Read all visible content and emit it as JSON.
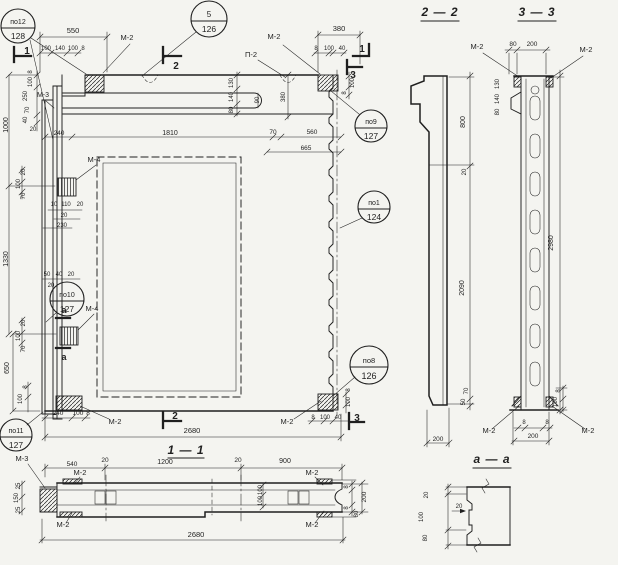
{
  "drawing": {
    "bg_color": "#f4f4f0",
    "ink_color": "#1f1f1f",
    "section_titles": {
      "s11": "1 — 1",
      "s22": "2 — 2",
      "s33": "3 — 3",
      "saa": "а — а"
    },
    "callouts": [
      {
        "top": "по12",
        "bot": "128"
      },
      {
        "top": "5",
        "bot": "126"
      },
      {
        "top": "по9",
        "bot": "127"
      },
      {
        "top": "по1",
        "bot": "124"
      },
      {
        "top": "по8",
        "bot": "126"
      },
      {
        "top": "по10",
        "bot": "127"
      },
      {
        "top": "по11",
        "bot": "127"
      }
    ],
    "labels": [
      {
        "t": "550",
        "x": 73,
        "y": 33
      },
      {
        "t": "100",
        "x": 46,
        "y": 50,
        "f": 6
      },
      {
        "t": "140",
        "x": 60,
        "y": 50,
        "f": 6
      },
      {
        "t": "100",
        "x": 73,
        "y": 50,
        "f": 6
      },
      {
        "t": "8",
        "x": 83,
        "y": 50,
        "f": 6
      },
      {
        "t": "М-2",
        "x": 127,
        "y": 40,
        "n": "mark"
      },
      {
        "t": "380",
        "x": 339,
        "y": 31
      },
      {
        "t": "8",
        "x": 316,
        "y": 50,
        "f": 6
      },
      {
        "t": "100",
        "x": 329,
        "y": 50,
        "f": 6
      },
      {
        "t": "40",
        "x": 342,
        "y": 50,
        "f": 6
      },
      {
        "t": "М-2",
        "x": 274,
        "y": 39,
        "n": "mark"
      },
      {
        "t": "П-2",
        "x": 251,
        "y": 57,
        "n": "mark"
      },
      {
        "t": "1",
        "x": 27,
        "y": 54,
        "f": 10,
        "n": "sec"
      },
      {
        "t": "2",
        "x": 176,
        "y": 69,
        "f": 10,
        "n": "sec"
      },
      {
        "t": "1",
        "x": 362,
        "y": 52,
        "f": 10,
        "n": "sec"
      },
      {
        "t": "3",
        "x": 353,
        "y": 78,
        "f": 10,
        "n": "sec"
      },
      {
        "t": "2",
        "x": 175,
        "y": 419,
        "f": 10,
        "n": "sec"
      },
      {
        "t": "3",
        "x": 357,
        "y": 421,
        "f": 10,
        "n": "sec"
      },
      {
        "t": "130",
        "x": 233,
        "y": 83,
        "r": 1,
        "f": 6
      },
      {
        "t": "140",
        "x": 233,
        "y": 97,
        "r": 1,
        "f": 6
      },
      {
        "t": "80",
        "x": 233,
        "y": 110,
        "r": 1,
        "f": 6
      },
      {
        "t": "90",
        "x": 259,
        "y": 100,
        "r": 1,
        "f": 6
      },
      {
        "t": "380",
        "x": 285,
        "y": 97,
        "r": 1,
        "f": 6
      },
      {
        "t": "100",
        "x": 354,
        "y": 83,
        "r": 1,
        "f": 6
      },
      {
        "t": "8",
        "x": 346,
        "y": 93,
        "r": 1,
        "f": 6
      },
      {
        "t": "8",
        "x": 32,
        "y": 72,
        "r": 1,
        "f": 6
      },
      {
        "t": "100",
        "x": 32,
        "y": 82,
        "r": 1,
        "f": 6
      },
      {
        "t": "250",
        "x": 27,
        "y": 96,
        "r": 1,
        "f": 6
      },
      {
        "t": "М-3",
        "x": 43,
        "y": 97,
        "n": "mark",
        "f": 7
      },
      {
        "t": "70",
        "x": 29,
        "y": 110,
        "r": 1,
        "f": 6
      },
      {
        "t": "40",
        "x": 27,
        "y": 120,
        "r": 1,
        "f": 6
      },
      {
        "t": "1000",
        "x": 8,
        "y": 125,
        "r": 1,
        "f": 7
      },
      {
        "t": "20",
        "x": 33,
        "y": 131,
        "f": 6
      },
      {
        "t": "240",
        "x": 59,
        "y": 135,
        "f": 6.5
      },
      {
        "t": "1810",
        "x": 170,
        "y": 135,
        "f": 7
      },
      {
        "t": "70",
        "x": 273,
        "y": 134,
        "f": 6.5
      },
      {
        "t": "560",
        "x": 312,
        "y": 134,
        "f": 6.5
      },
      {
        "t": "665",
        "x": 306,
        "y": 150,
        "f": 6.5
      },
      {
        "t": "М-4",
        "x": 94,
        "y": 162,
        "n": "mark"
      },
      {
        "t": "20",
        "x": 25,
        "y": 172,
        "r": 1,
        "f": 6
      },
      {
        "t": "100",
        "x": 20,
        "y": 184,
        "r": 1,
        "f": 6
      },
      {
        "t": "70",
        "x": 25,
        "y": 196,
        "r": 1,
        "f": 6
      },
      {
        "t": "10",
        "x": 54,
        "y": 206,
        "f": 6
      },
      {
        "t": "110",
        "x": 66,
        "y": 206,
        "f": 6
      },
      {
        "t": "20",
        "x": 80,
        "y": 206,
        "f": 6
      },
      {
        "t": "20",
        "x": 64,
        "y": 217,
        "f": 6
      },
      {
        "t": "230",
        "x": 62,
        "y": 227,
        "f": 6
      },
      {
        "t": "1330",
        "x": 8,
        "y": 259,
        "r": 1,
        "f": 7
      },
      {
        "t": "50",
        "x": 47,
        "y": 276,
        "f": 6
      },
      {
        "t": "40",
        "x": 59,
        "y": 276,
        "f": 6
      },
      {
        "t": "20",
        "x": 71,
        "y": 276,
        "f": 6
      },
      {
        "t": "20",
        "x": 51,
        "y": 287,
        "f": 6
      },
      {
        "t": "М-4",
        "x": 92,
        "y": 311,
        "n": "mark"
      },
      {
        "t": "а",
        "x": 64,
        "y": 313,
        "f": 9,
        "n": "sec"
      },
      {
        "t": "а",
        "x": 64,
        "y": 360,
        "f": 9,
        "n": "sec"
      },
      {
        "t": "20",
        "x": 25,
        "y": 323,
        "r": 1,
        "f": 6
      },
      {
        "t": "100",
        "x": 20,
        "y": 336,
        "r": 1,
        "f": 6
      },
      {
        "t": "70",
        "x": 25,
        "y": 349,
        "r": 1,
        "f": 6
      },
      {
        "t": "650",
        "x": 9,
        "y": 368,
        "r": 1,
        "f": 7
      },
      {
        "t": "8",
        "x": 27,
        "y": 387,
        "r": 1,
        "f": 6
      },
      {
        "t": "100",
        "x": 22,
        "y": 399,
        "r": 1,
        "f": 6
      },
      {
        "t": "240",
        "x": 58,
        "y": 415,
        "f": 6.5
      },
      {
        "t": "100",
        "x": 78,
        "y": 415,
        "f": 6.5
      },
      {
        "t": "8",
        "x": 88,
        "y": 415,
        "f": 6.5
      },
      {
        "t": "М-2",
        "x": 115,
        "y": 424,
        "n": "mark"
      },
      {
        "t": "М-2",
        "x": 287,
        "y": 424,
        "n": "mark"
      },
      {
        "t": "8",
        "x": 313,
        "y": 419,
        "f": 6
      },
      {
        "t": "100",
        "x": 325,
        "y": 419,
        "f": 6
      },
      {
        "t": "40",
        "x": 338,
        "y": 419,
        "f": 6
      },
      {
        "t": "100",
        "x": 350,
        "y": 402,
        "r": 1,
        "f": 6
      },
      {
        "t": "8",
        "x": 350,
        "y": 390,
        "r": 1,
        "f": 6
      },
      {
        "t": "2680",
        "x": 192,
        "y": 433,
        "f": 7.5
      },
      {
        "t": "М-3",
        "x": 22,
        "y": 461,
        "n": "mark"
      },
      {
        "t": "540",
        "x": 72,
        "y": 466,
        "f": 6.5
      },
      {
        "t": "20",
        "x": 105,
        "y": 462,
        "f": 6.5
      },
      {
        "t": "1200",
        "x": 165,
        "y": 464,
        "f": 7
      },
      {
        "t": "20",
        "x": 238,
        "y": 462,
        "f": 6.5
      },
      {
        "t": "900",
        "x": 285,
        "y": 463,
        "f": 7
      },
      {
        "t": "М-2",
        "x": 80,
        "y": 475,
        "n": "mark"
      },
      {
        "t": "М-2",
        "x": 63,
        "y": 527,
        "n": "mark"
      },
      {
        "t": "М-2",
        "x": 312,
        "y": 475,
        "n": "mark"
      },
      {
        "t": "М-2",
        "x": 312,
        "y": 527,
        "n": "mark"
      },
      {
        "t": "25",
        "x": 20,
        "y": 486,
        "r": 1,
        "f": 6
      },
      {
        "t": "150",
        "x": 18,
        "y": 498,
        "r": 1,
        "f": 6
      },
      {
        "t": "25",
        "x": 20,
        "y": 510,
        "r": 1,
        "f": 6
      },
      {
        "t": "100",
        "x": 262,
        "y": 490,
        "r": 1,
        "f": 6
      },
      {
        "t": "100",
        "x": 262,
        "y": 501,
        "r": 1,
        "f": 6
      },
      {
        "t": "8",
        "x": 348,
        "y": 487,
        "r": 1,
        "f": 6
      },
      {
        "t": "200",
        "x": 366,
        "y": 497,
        "r": 1,
        "f": 6.5
      },
      {
        "t": "8",
        "x": 348,
        "y": 508,
        "r": 1,
        "f": 6
      },
      {
        "t": "80",
        "x": 358,
        "y": 514,
        "r": 1,
        "f": 6
      },
      {
        "t": "2680",
        "x": 196,
        "y": 537,
        "f": 7.5
      },
      {
        "t": "800",
        "x": 465,
        "y": 122,
        "r": 1,
        "f": 7
      },
      {
        "t": "20",
        "x": 466,
        "y": 172,
        "r": 1,
        "f": 6
      },
      {
        "t": "2090",
        "x": 464,
        "y": 288,
        "r": 1,
        "f": 7
      },
      {
        "t": "70",
        "x": 468,
        "y": 391,
        "r": 1,
        "f": 6
      },
      {
        "t": "50",
        "x": 465,
        "y": 402,
        "r": 1,
        "f": 6
      },
      {
        "t": "200",
        "x": 438,
        "y": 441,
        "f": 6.5
      },
      {
        "t": "80",
        "x": 513,
        "y": 46,
        "f": 6.5
      },
      {
        "t": "200",
        "x": 532,
        "y": 46,
        "f": 6.5
      },
      {
        "t": "М-2",
        "x": 477,
        "y": 49,
        "n": "mark"
      },
      {
        "t": "М-2",
        "x": 586,
        "y": 52,
        "n": "mark"
      },
      {
        "t": "130",
        "x": 499,
        "y": 84,
        "r": 1,
        "f": 6
      },
      {
        "t": "140",
        "x": 499,
        "y": 99,
        "r": 1,
        "f": 6
      },
      {
        "t": "80",
        "x": 499,
        "y": 112,
        "r": 1,
        "f": 6
      },
      {
        "t": "2980",
        "x": 553,
        "y": 243,
        "r": 1,
        "f": 7
      },
      {
        "t": "8",
        "x": 560,
        "y": 391,
        "r": 1,
        "f": 6
      },
      {
        "t": "100",
        "x": 557,
        "y": 402,
        "r": 1,
        "f": 6
      },
      {
        "t": "8",
        "x": 524,
        "y": 424,
        "f": 6
      },
      {
        "t": "8",
        "x": 547,
        "y": 424,
        "f": 6
      },
      {
        "t": "200",
        "x": 533,
        "y": 438,
        "f": 6.5
      },
      {
        "t": "М-2",
        "x": 489,
        "y": 433,
        "n": "mark"
      },
      {
        "t": "М-2",
        "x": 588,
        "y": 433,
        "n": "mark"
      },
      {
        "t": "20",
        "x": 428,
        "y": 495,
        "r": 1,
        "f": 6
      },
      {
        "t": "100",
        "x": 423,
        "y": 517,
        "r": 1,
        "f": 6
      },
      {
        "t": "80",
        "x": 427,
        "y": 538,
        "r": 1,
        "f": 6
      },
      {
        "t": "20",
        "x": 459,
        "y": 508,
        "f": 6
      }
    ]
  }
}
